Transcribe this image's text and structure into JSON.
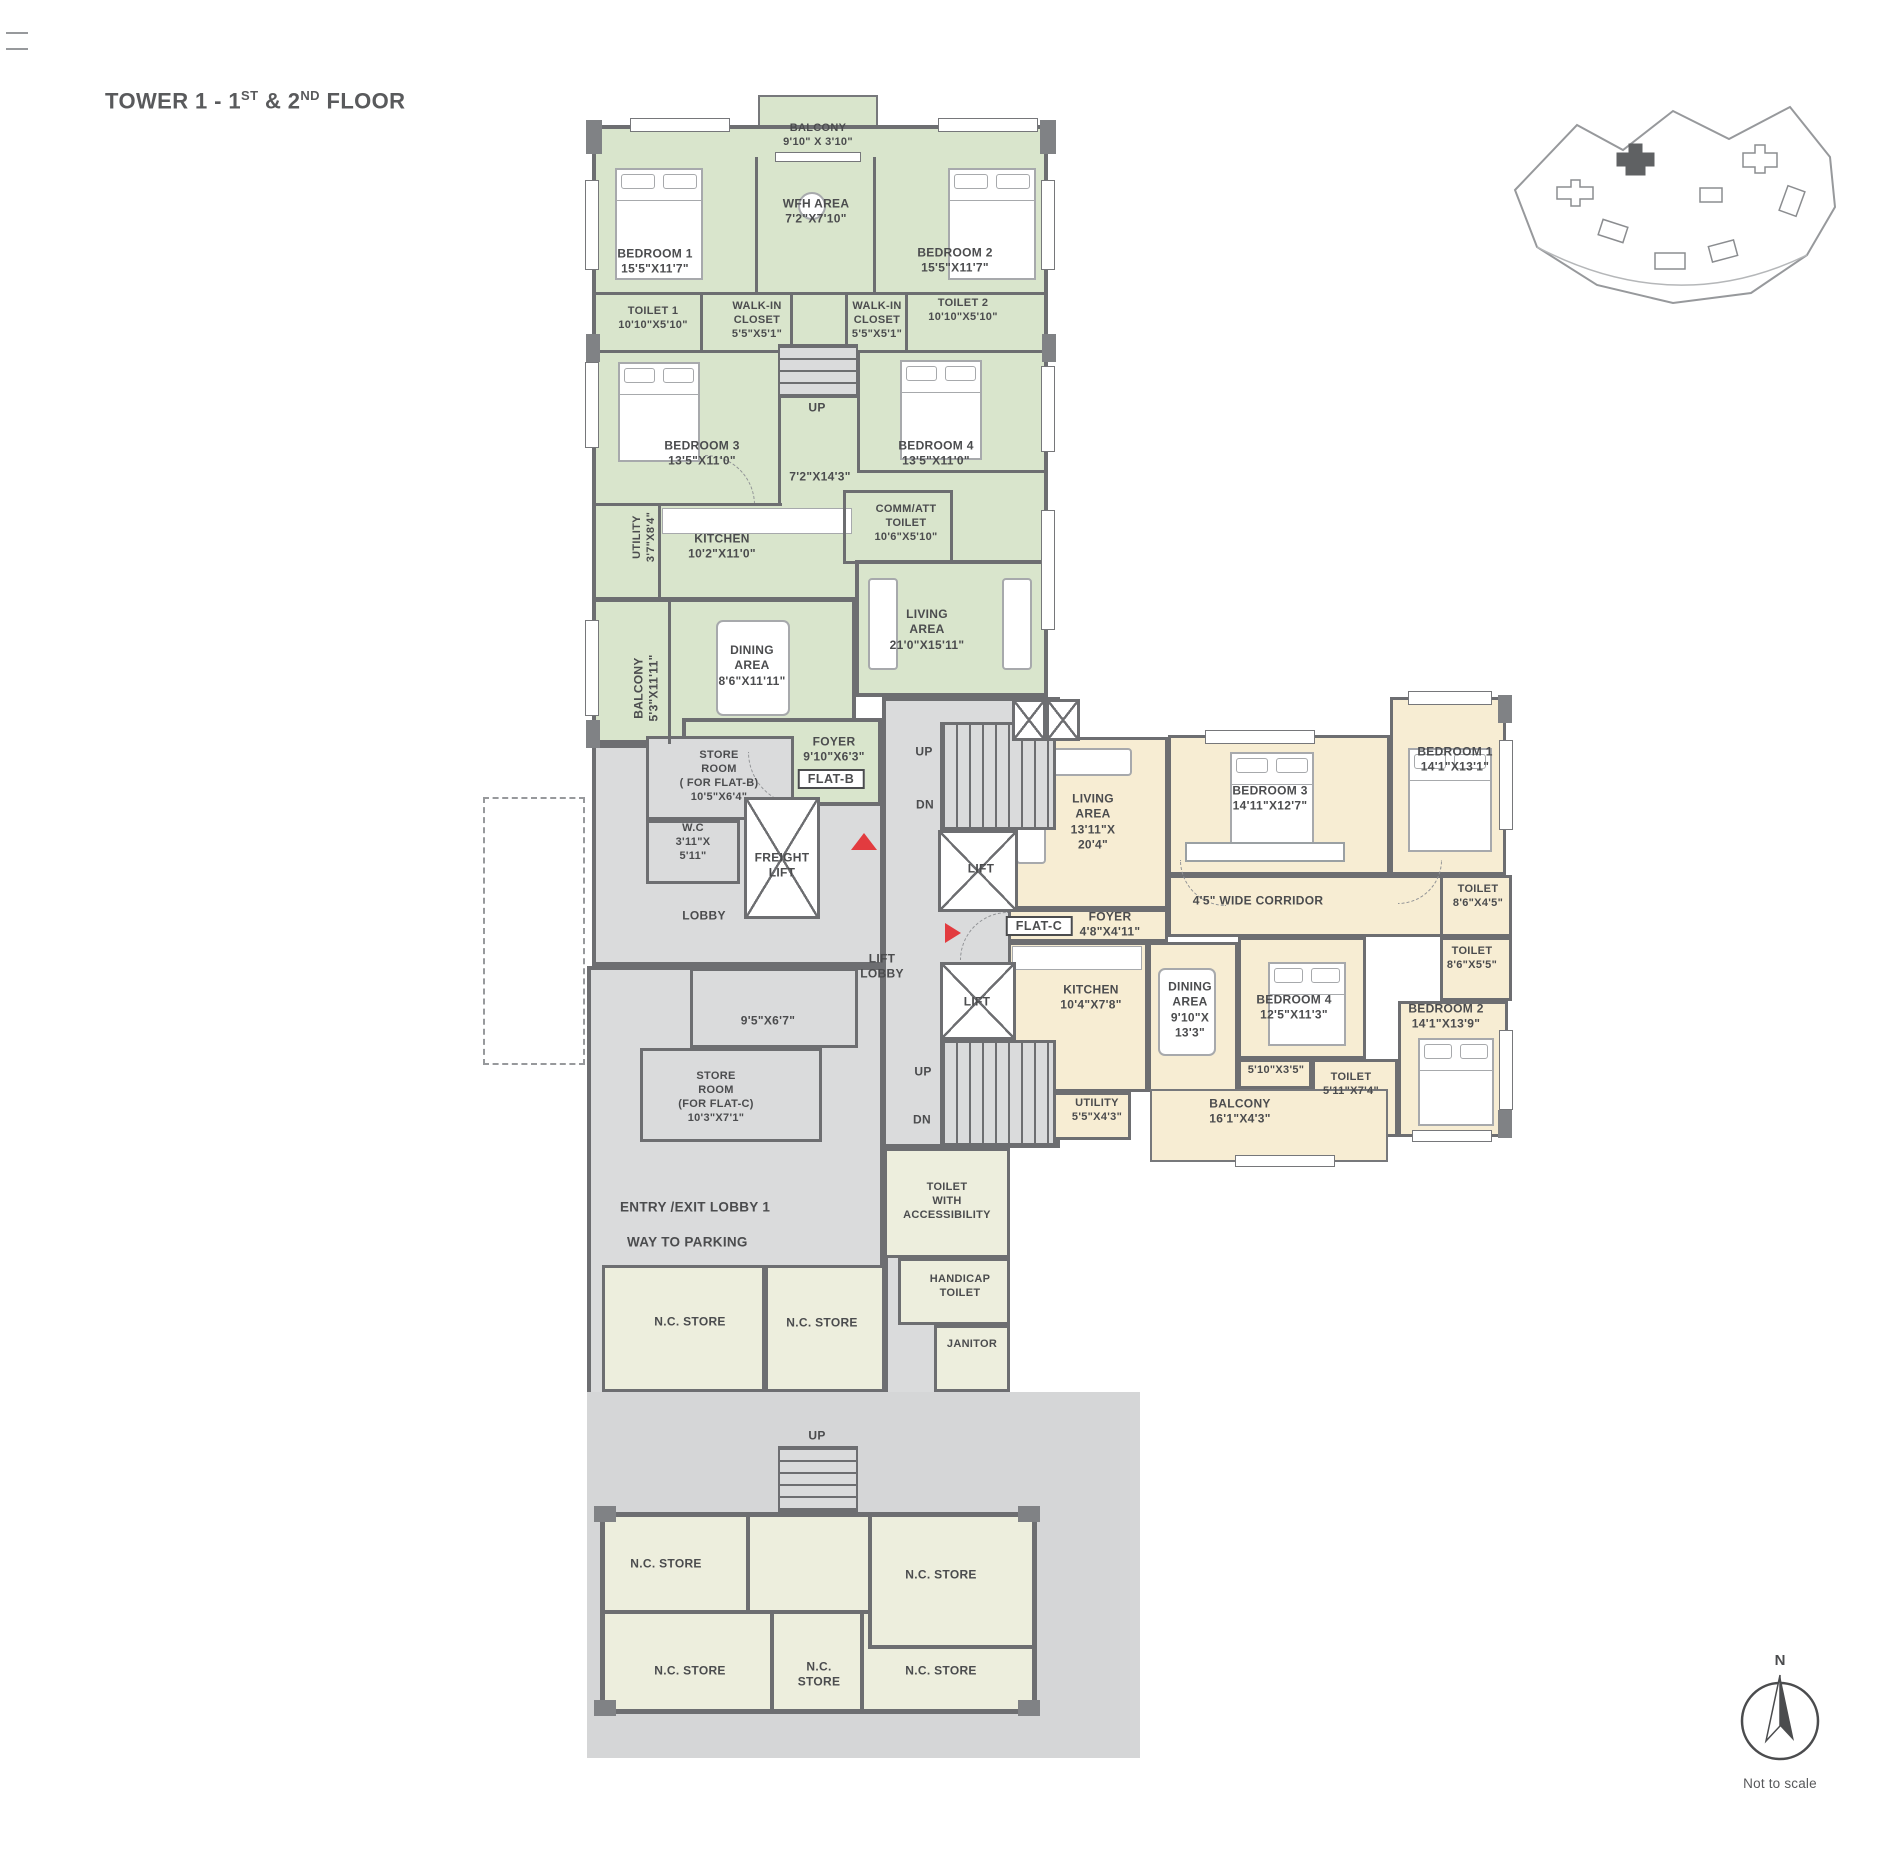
{
  "title": {
    "part1": "TOWER 1 - 1",
    "sup1": "ST",
    "part2": " & 2",
    "sup2": "ND",
    "part3": " FLOOR"
  },
  "colors": {
    "flat_b_fill": "#d9e5cc",
    "flat_c_fill": "#f7edd3",
    "common_fill": "#dadbdc",
    "store_fill": "#edeedd",
    "wall": "#6d6e71",
    "entry_marker": "#e23b3f",
    "text": "#4b4c4e"
  },
  "flat_b": {
    "balcony_top": {
      "l1": "BALCONY",
      "l2": "9'10\" X 3'10\""
    },
    "bedroom1": {
      "l1": "BEDROOM 1",
      "l2": "15'5\"X11'7\""
    },
    "wfh": {
      "l1": "WFH AREA",
      "l2": "7'2\"X7'10\""
    },
    "bedroom2": {
      "l1": "BEDROOM 2",
      "l2": "15'5\"X11'7\""
    },
    "toilet1": {
      "l1": "TOILET 1",
      "l2": "10'10\"X5'10\""
    },
    "walkin1": {
      "l1": "WALK-IN",
      "l2": "CLOSET",
      "l3": "5'5\"X5'1\""
    },
    "walkin2": {
      "l1": "WALK-IN",
      "l2": "CLOSET",
      "l3": "5'5\"X5'1\""
    },
    "toilet2": {
      "l1": "TOILET 2",
      "l2": "10'10\"X5'10\""
    },
    "up_top": "UP",
    "bedroom3": {
      "l1": "BEDROOM 3",
      "l2": "13'5\"X11'0\""
    },
    "bedroom4": {
      "l1": "BEDROOM 4",
      "l2": "13'5\"X11'0\""
    },
    "passage": "7'2\"X14'3\"",
    "comm_att": {
      "l1": "COMM/ATT",
      "l2": "TOILET",
      "l3": "10'6\"X5'10\""
    },
    "utility": {
      "l1": "UTILITY",
      "l2": "3'7\"X8'4\""
    },
    "kitchen": {
      "l1": "KITCHEN",
      "l2": "10'2\"X11'0\""
    },
    "dining": {
      "l1": "DINING",
      "l2": "AREA",
      "l3": "8'6\"X11'11\""
    },
    "balcony_side": {
      "l1": "BALCONY",
      "l2": "5'3\"X11'11\""
    },
    "living": {
      "l1": "LIVING",
      "l2": "AREA",
      "l3": "21'0\"X15'11\""
    },
    "store_room": {
      "l1": "STORE",
      "l2": "ROOM",
      "l3": "( FOR FLAT-B)",
      "l4": "10'5\"X6'4\""
    },
    "foyer": {
      "l1": "FOYER",
      "l2": "9'10\"X6'3\""
    },
    "tag": "FLAT-B",
    "wc": {
      "l1": "W.C",
      "l2": "3'11\"X",
      "l3": "5'11\""
    }
  },
  "core": {
    "lobby": "LOBBY",
    "freight": {
      "l1": "FREIGHT",
      "l2": "LIFT"
    },
    "lift": "LIFT",
    "lift2": "LIFT",
    "up": "UP",
    "dn": "DN",
    "up2": "UP",
    "dn2": "DN",
    "lift_lobby": {
      "l1": "LIFT",
      "l2": "LOBBY"
    },
    "store_c": {
      "l1": "STORE",
      "l2": "ROOM",
      "l3": "(FOR FLAT-C)",
      "l4": "10'3\"X7'1\""
    },
    "store_c_dim": "9'5\"X6'7\""
  },
  "flat_c": {
    "living": {
      "l1": "LIVING",
      "l2": "AREA",
      "l3": "13'11\"X",
      "l4": "20'4\""
    },
    "bedroom3": {
      "l1": "BEDROOM 3",
      "l2": "14'11\"X12'7\""
    },
    "bedroom1": {
      "l1": "BEDROOM 1",
      "l2": "14'1\"X13'1\""
    },
    "corridor": "4'5\" WIDE CORRIDOR",
    "toilet_a": {
      "l1": "TOILET",
      "l2": "8'6\"X4'5\""
    },
    "toilet_b": {
      "l1": "TOILET",
      "l2": "8'6\"X5'5\""
    },
    "foyer": {
      "l1": "FOYER",
      "l2": "4'8\"X4'11\""
    },
    "tag": "FLAT-C",
    "kitchen": {
      "l1": "KITCHEN",
      "l2": "10'4\"X7'8\""
    },
    "dining": {
      "l1": "DINING",
      "l2": "AREA",
      "l3": "9'10\"X",
      "l4": "13'3\""
    },
    "bedroom4": {
      "l1": "BEDROOM 4",
      "l2": "12'5\"X11'3\""
    },
    "passage": "5'10\"X3'5\"",
    "toilet_c": {
      "l1": "TOILET",
      "l2": "5'11\"X7'4\""
    },
    "balcony": {
      "l1": "BALCONY",
      "l2": "16'1\"X4'3\""
    },
    "utility": {
      "l1": "UTILITY",
      "l2": "5'5\"X4'3\""
    },
    "bedroom2": {
      "l1": "BEDROOM 2",
      "l2": "14'1\"X13'9\""
    }
  },
  "ground": {
    "entry_lobby": "ENTRY /EXIT LOBBY 1",
    "way_parking": "WAY TO PARKING",
    "toilet_access": {
      "l1": "TOILET",
      "l2": "WITH",
      "l3": "ACCESSIBILITY"
    },
    "handicap": {
      "l1": "HANDICAP",
      "l2": "TOILET"
    },
    "janitor": "JANITOR",
    "nc": "N.C. STORE",
    "nc_two_line": {
      "l1": "N.C.",
      "l2": "STORE"
    },
    "up": "UP"
  },
  "footer": {
    "north": "N",
    "not_to_scale": "Not to scale"
  }
}
